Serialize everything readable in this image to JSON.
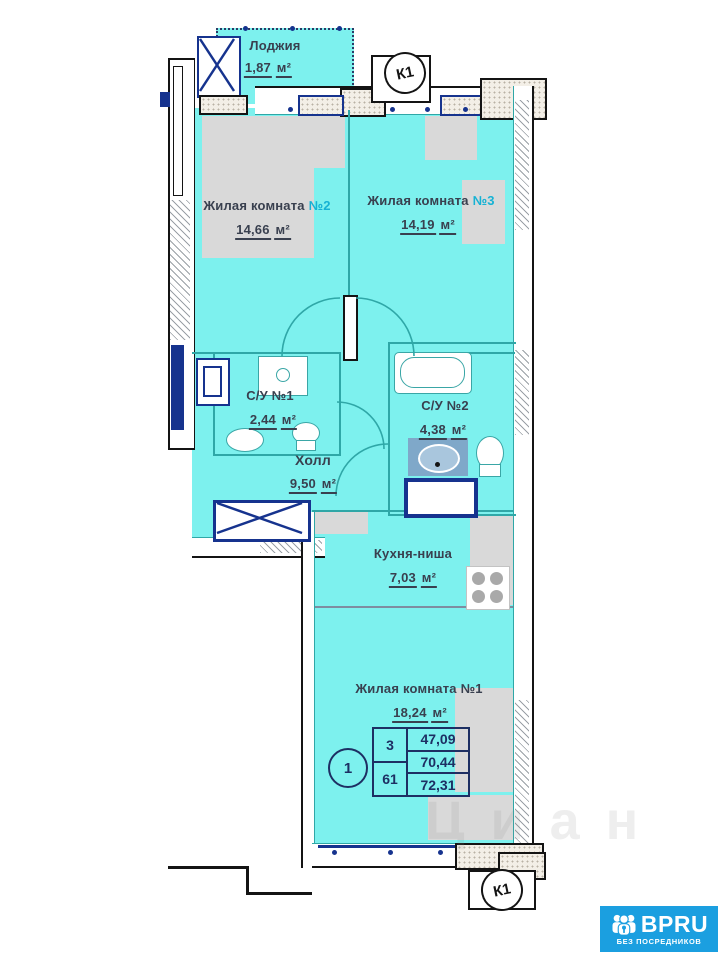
{
  "watermark": "Циан",
  "markers": {
    "k1_top": "К1",
    "k1_bottom": "К1",
    "unit_circle": "1"
  },
  "rooms": {
    "loggia": {
      "name": "Лоджия",
      "area": "1,87",
      "unit": "м²"
    },
    "room2": {
      "name": "Жилая комната",
      "num": "№2",
      "area": "14,66",
      "unit": "м²"
    },
    "room3": {
      "name": "Жилая комната",
      "num": "№3",
      "area": "14,19",
      "unit": "м²"
    },
    "su1": {
      "name": "С/У №1",
      "area": "2,44",
      "unit": "м²"
    },
    "su2": {
      "name": "С/У №2",
      "area": "4,38",
      "unit": "м²"
    },
    "hall": {
      "name": "Холл",
      "area": "9,50",
      "unit": "м²"
    },
    "kitchen": {
      "name": "Кухня-ниша",
      "area": "7,03",
      "unit": "м²"
    },
    "room1": {
      "name": "Жилая комната",
      "num": "№1",
      "area": "18,24",
      "unit": "м²"
    }
  },
  "info_table": {
    "left": [
      "3",
      "61"
    ],
    "right": [
      "47,09",
      "70,44",
      "72,31"
    ]
  },
  "logo": {
    "brand": "BPRU",
    "tagline": "БЕЗ ПОСРЕДНИКОВ",
    "color": "#1b9fe0"
  },
  "colors": {
    "room_fill": "#7df1ee",
    "wall_accent": "#16338e",
    "text": "#39404f"
  }
}
